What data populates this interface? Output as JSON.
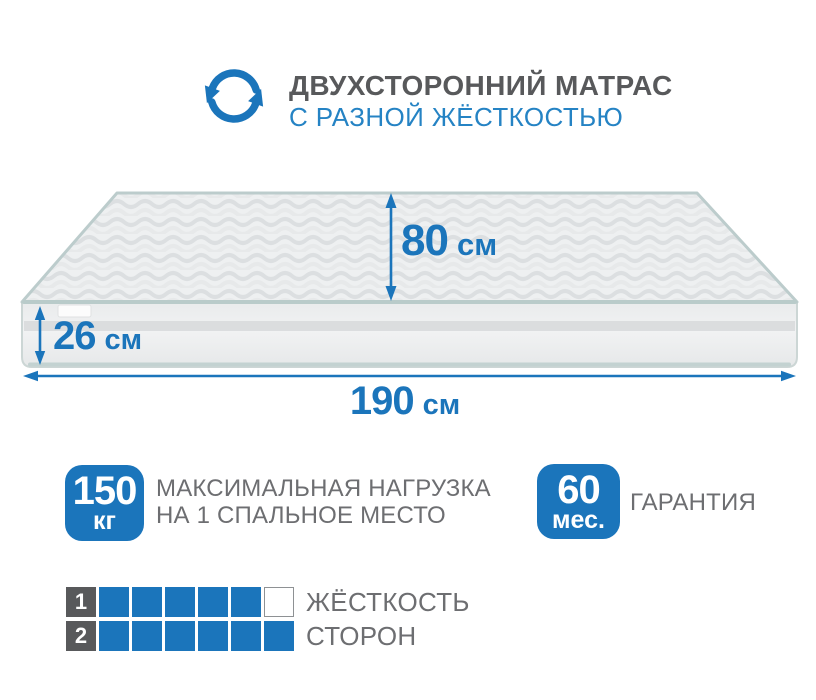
{
  "header": {
    "title": "ДВУХСТОРОННИЙ МАТРАС",
    "subtitle": "С РАЗНОЙ ЖЁСТКОСТЬЮ",
    "icon": "rotate-arrows-icon"
  },
  "dimensions": {
    "depth": {
      "value": "80",
      "unit": "см"
    },
    "height": {
      "value": "26",
      "unit": "см"
    },
    "length": {
      "value": "190",
      "unit": "см"
    }
  },
  "badges": {
    "load": {
      "value": "150",
      "unit": "кг",
      "label_line1": "МАКСИМАЛЬНАЯ НАГРУЗКА",
      "label_line2": "НА 1 СПАЛЬНОЕ МЕСТО"
    },
    "warranty": {
      "value": "60",
      "unit": "мес.",
      "label": "ГАРАНТИЯ"
    }
  },
  "firmness": {
    "rows": [
      {
        "label": "1",
        "filled": 5,
        "total": 6
      },
      {
        "label": "2",
        "filled": 6,
        "total": 6
      }
    ],
    "caption_line1": "ЖЁСТКОСТЬ",
    "caption_line2": "СТОРОН"
  },
  "colors": {
    "primary_blue": "#1b75bb",
    "subtitle_blue": "#2583c4",
    "title_gray": "#58595b",
    "text_gray": "#6d6e71",
    "piping": "#c0d0d0",
    "side_stripe": "#d7d9da"
  }
}
